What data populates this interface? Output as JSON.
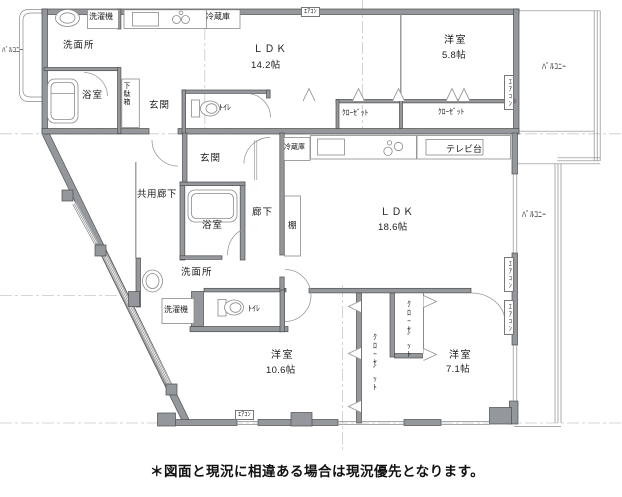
{
  "plan": {
    "footer_note": "＊図面と現況に相違ある場合は現況優先となります。",
    "unit_a": {
      "balcony_left": "ﾊﾞﾙｺﾆｰ",
      "washing_machine": "洗濯機",
      "refrigerator": "冷蔵庫",
      "washroom": "洗面所",
      "bathroom": "浴室",
      "shoe_cabinet": "下駄箱",
      "entrance": "玄関",
      "toilet": "ﾄｲﾚ",
      "ldk_name": "ＬＤＫ",
      "ldk_size": "14.2帖",
      "bedroom_name": "洋室",
      "bedroom_size": "5.8帖",
      "closet_left": "ｸﾛｰｾﾞｯﾄ",
      "closet_right": "ｸﾛｰｾﾞｯﾄ",
      "balcony_right": "ﾊﾞﾙｺﾆｰ",
      "aircon_top": "ｴｱｺﾝ",
      "aircon_right": "ｴｱｺﾝ"
    },
    "unit_b": {
      "shared_corridor": "共用廊下",
      "entrance": "玄関",
      "refrigerator": "冷蔵庫",
      "tv_stand": "テレビ台",
      "bathroom": "浴室",
      "corridor": "廊下",
      "shelf": "棚",
      "ldk_name": "ＬＤＫ",
      "ldk_size": "18.6帖",
      "balcony_right": "ﾊﾞﾙｺﾆｰ",
      "washroom": "洗面所",
      "washing_machine": "洗濯機",
      "toilet": "ﾄｲﾚ",
      "bedroom_large_name": "洋室",
      "bedroom_large_size": "10.6帖",
      "bedroom_small_name": "洋室",
      "bedroom_small_size": "7.1帖",
      "closet_tall": "ｸﾛｰｾﾞｯﾄ",
      "closet_upper": "ｸﾛｰｾﾞｯﾄ",
      "aircon_right_upper": "ｴｱｺﾝ",
      "aircon_right_lower": "ｴｱｺﾝ",
      "aircon_bottom": "ｴｱｺﾝ"
    },
    "colors": {
      "wall": "#94989c",
      "wall_edge": "#4e4e4e",
      "thin_line": "#8a8a8a",
      "centerline": "#c6cacd",
      "text": "#1c1c1c"
    }
  }
}
